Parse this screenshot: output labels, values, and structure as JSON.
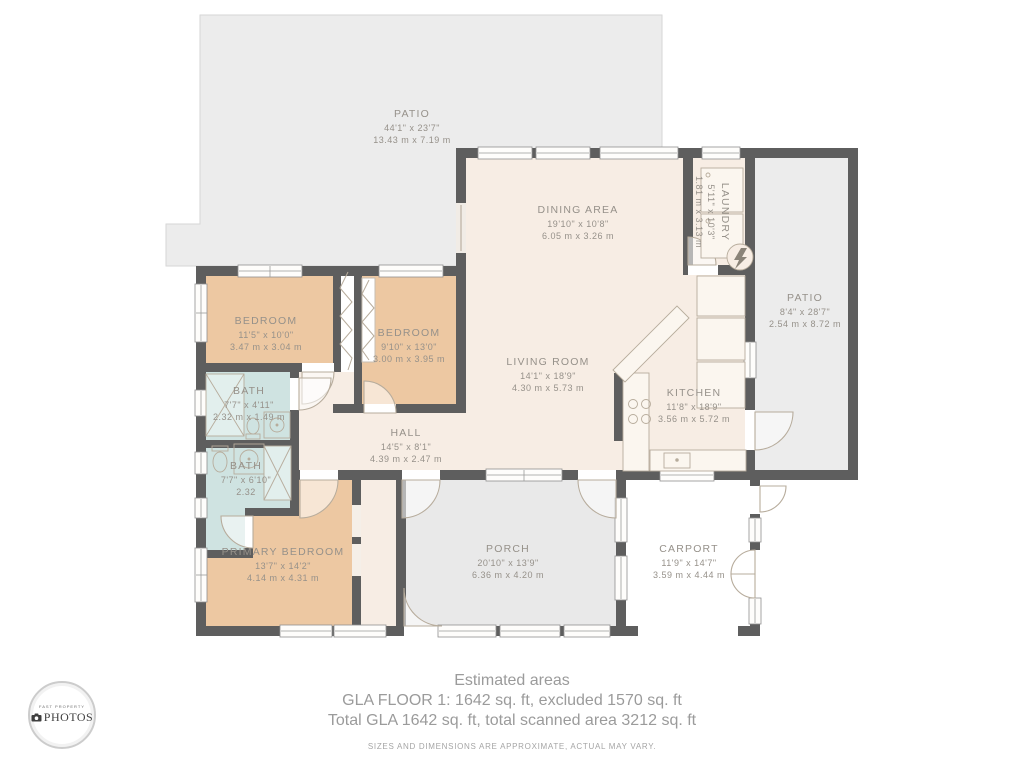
{
  "rooms": [
    {
      "id": "patio-top",
      "name": "PATIO",
      "imperial": "44'1\" x 23'7\"",
      "metric": "13.43 m x 7.19 m"
    },
    {
      "id": "dining-area",
      "name": "DINING AREA",
      "imperial": "19'10\" x 10'8\"",
      "metric": "6.05 m x 3.26 m"
    },
    {
      "id": "laundry",
      "name": "LAUNDRY",
      "imperial": "5'11\" x 10'3\"",
      "metric": "1.81 m x 3.13 m"
    },
    {
      "id": "patio-right",
      "name": "PATIO",
      "imperial": "8'4\" x 28'7\"",
      "metric": "2.54 m x 8.72 m"
    },
    {
      "id": "bedroom-1",
      "name": "BEDROOM",
      "imperial": "11'5\" x 10'0\"",
      "metric": "3.47 m x 3.04 m"
    },
    {
      "id": "bedroom-2",
      "name": "BEDROOM",
      "imperial": "9'10\" x 13'0\"",
      "metric": "3.00 m x 3.95 m"
    },
    {
      "id": "living-room",
      "name": "LIVING ROOM",
      "imperial": "14'1\" x 18'9\"",
      "metric": "4.30 m x 5.73 m"
    },
    {
      "id": "kitchen",
      "name": "KITCHEN",
      "imperial": "11'8\" x 18'9\"",
      "metric": "3.56 m x 5.72 m"
    },
    {
      "id": "bath-1",
      "name": "BATH",
      "imperial": "7'7\" x 4'11\"",
      "metric": "2.32 m x 1.49 m"
    },
    {
      "id": "hall",
      "name": "HALL",
      "imperial": "14'5\" x 8'1\"",
      "metric": "4.39 m x 2.47 m"
    },
    {
      "id": "bath-2",
      "name": "BATH",
      "imperial": "7'7\" x 6'10\"",
      "metric": "2.32"
    },
    {
      "id": "primary-bedroom",
      "name": "PRIMARY BEDROOM",
      "imperial": "13'7\" x 14'2\"",
      "metric": "4.14 m x 4.31 m"
    },
    {
      "id": "porch",
      "name": "PORCH",
      "imperial": "20'10\" x 13'9\"",
      "metric": "6.36 m x 4.20 m"
    },
    {
      "id": "carport",
      "name": "CARPORT",
      "imperial": "11'9\" x 14'7\"",
      "metric": "3.59 m x 4.44 m"
    }
  ],
  "footer": {
    "title": "Estimated areas",
    "line1": "GLA FLOOR 1: 1642 sq. ft, excluded 1570 sq. ft",
    "line2": "Total GLA 1642 sq. ft, total scanned area 3212 sq. ft",
    "disclaimer": "SIZES AND DIMENSIONS ARE APPROXIMATE, ACTUAL MAY VARY."
  },
  "logo": {
    "brand_top": "FAST PROPERTY",
    "brand_main": "PHOTOS",
    "camera_icon": "camera-icon"
  },
  "colors": {
    "wall": "#5e5e5e",
    "room_cream": "#f7ede4",
    "bedroom_peach": "#edc8a2",
    "bath_blue": "#cfe3e1",
    "patio_gray": "#ececec",
    "porch_gray": "#e9e9e9",
    "label_text": "#96918a",
    "footer_text": "#9b9b9b"
  }
}
